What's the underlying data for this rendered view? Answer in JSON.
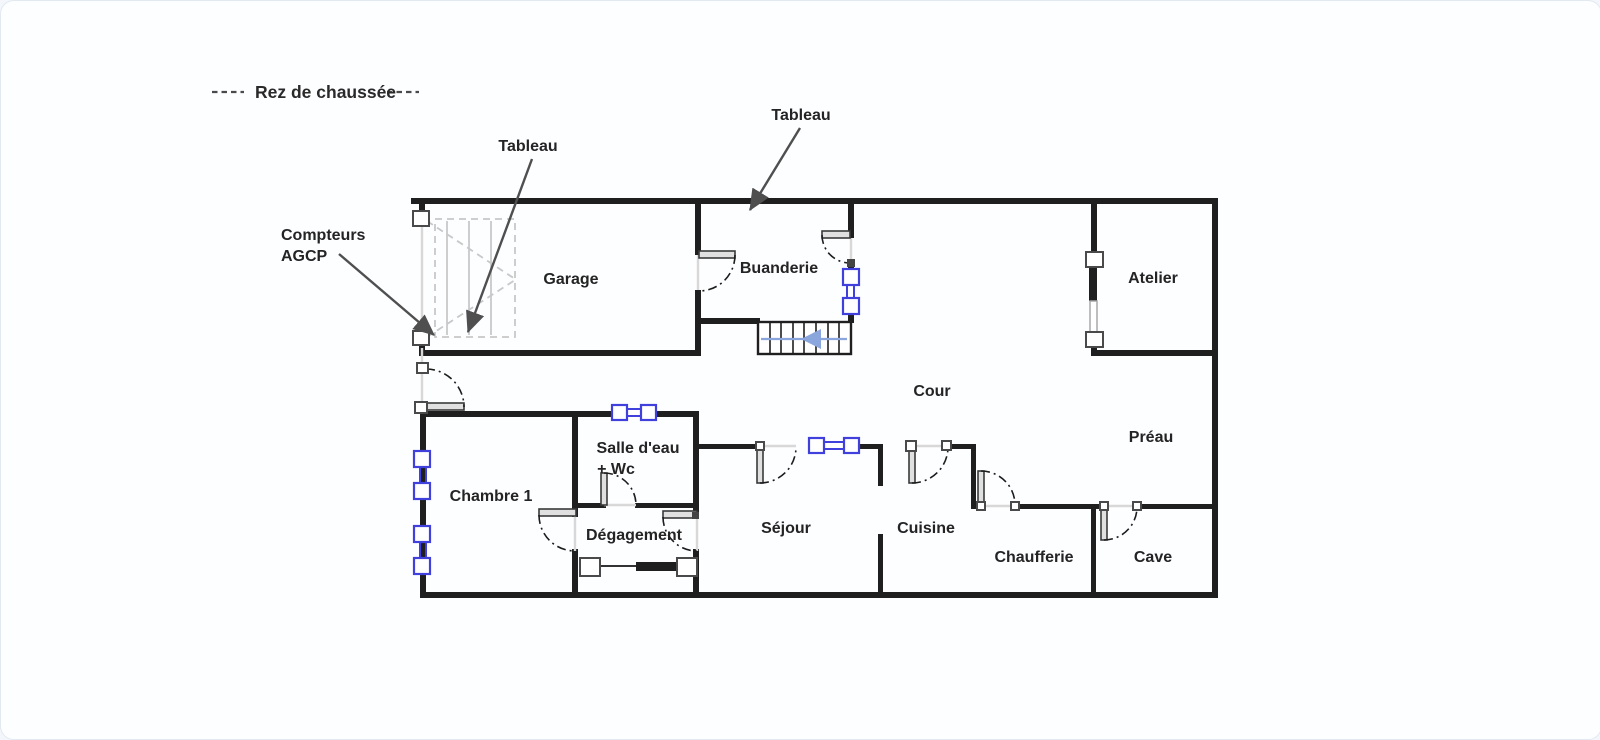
{
  "title": {
    "label": "Rez de chaussée"
  },
  "rooms": {
    "garage": "Garage",
    "buanderie": "Buanderie",
    "atelier": "Atelier",
    "cour": "Cour",
    "preau": "Préau",
    "chambre1": "Chambre 1",
    "salle_eau_line1": "Salle d'eau",
    "salle_eau_line2": "+ Wc",
    "degagement": "Dégagement",
    "sejour": "Séjour",
    "cuisine": "Cuisine",
    "chaufferie": "Chaufferie",
    "cave": "Cave"
  },
  "annotations": {
    "tableau_garage": "Tableau",
    "tableau_buanderie": "Tableau",
    "compteurs_line1": "Compteurs",
    "compteurs_line2": "AGCP"
  },
  "stairs": {
    "direction": "left"
  },
  "colors": {
    "wall": "#1f1f1f",
    "window_symbol": "#4040dd",
    "stair_arrow": "#8aa6dc",
    "door_opening": "#d8d8d8",
    "garage_marks": "#c8c8c8",
    "annotation_arrow": "#4f4f4f",
    "text": "#242424",
    "background": "#fdfeff"
  }
}
